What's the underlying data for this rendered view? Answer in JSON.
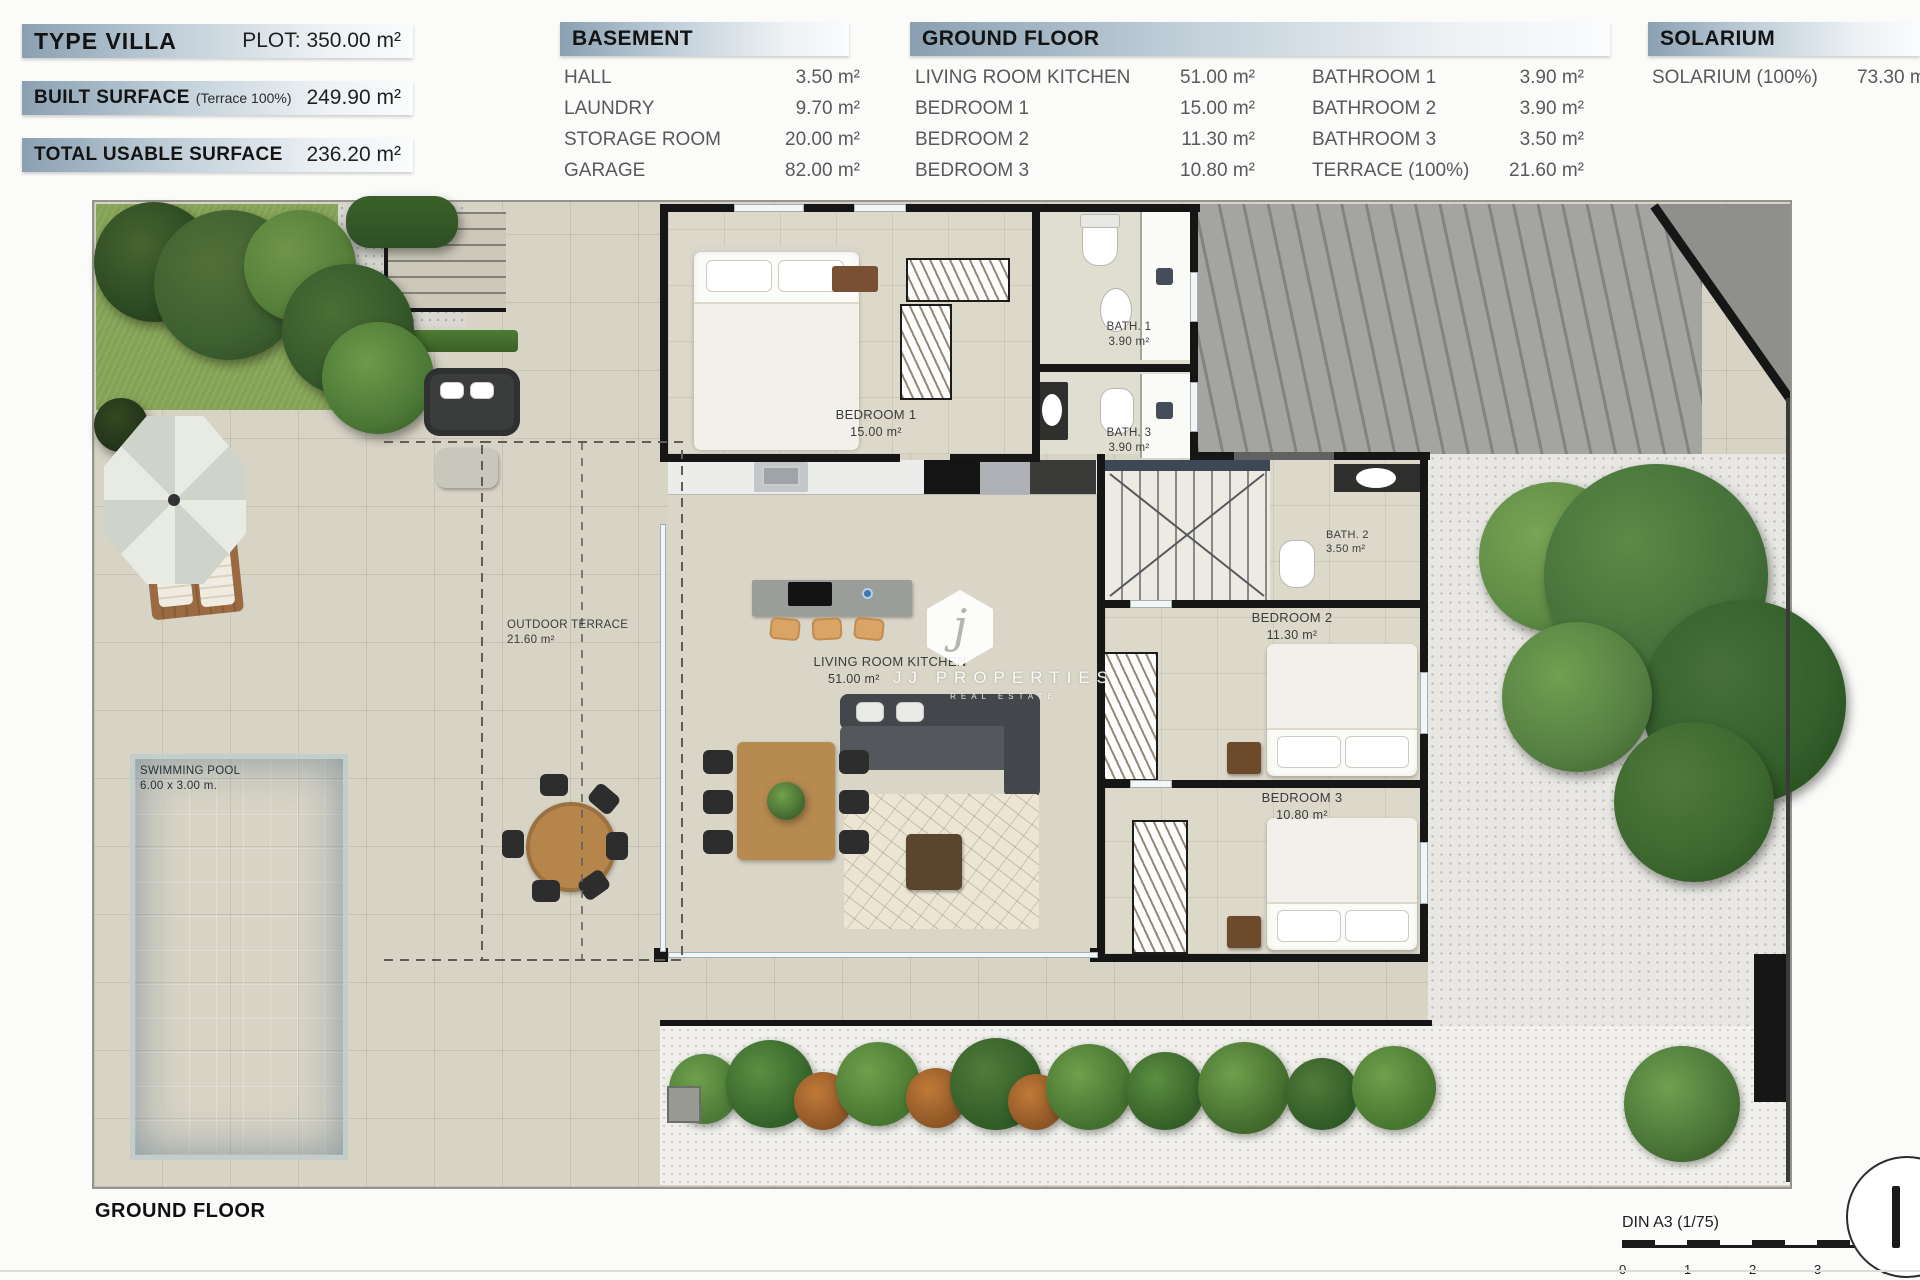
{
  "header": {
    "summary": [
      {
        "label": "TYPE VILLA",
        "sublabel": "",
        "value": "PLOT: 350.00 m²"
      },
      {
        "label": "BUILT SURFACE",
        "sublabel": "(Terrace 100%)",
        "value": "249.90 m²"
      },
      {
        "label": "TOTAL USABLE SURFACE",
        "sublabel": "",
        "value": "236.20 m²"
      }
    ],
    "basement": {
      "title": "BASEMENT",
      "rows": [
        {
          "label": "HALL",
          "value": "3.50 m²"
        },
        {
          "label": "LAUNDRY",
          "value": "9.70 m²"
        },
        {
          "label": "STORAGE ROOM",
          "value": "20.00 m²"
        },
        {
          "label": "GARAGE",
          "value": "82.00 m²"
        }
      ]
    },
    "ground_floor": {
      "title": "GROUND FLOOR",
      "col1": [
        {
          "label": "LIVING ROOM KITCHEN",
          "value": "51.00 m²"
        },
        {
          "label": "BEDROOM 1",
          "value": "15.00 m²"
        },
        {
          "label": "BEDROOM 2",
          "value": "11.30 m²"
        },
        {
          "label": "BEDROOM 3",
          "value": "10.80 m²"
        }
      ],
      "col2": [
        {
          "label": "BATHROOM 1",
          "value": "3.90 m²"
        },
        {
          "label": "BATHROOM 2",
          "value": "3.90 m²"
        },
        {
          "label": "BATHROOM 3",
          "value": "3.50 m²"
        },
        {
          "label": "TERRACE (100%)",
          "value": "21.60 m²"
        }
      ]
    },
    "solarium": {
      "title": "SOLARIUM",
      "rows": [
        {
          "label": "SOLARIUM (100%)",
          "value": "73.30 m²"
        }
      ]
    }
  },
  "plan": {
    "labels": {
      "bedroom1": {
        "name": "BEDROOM 1",
        "area": "15.00 m²"
      },
      "bath1": {
        "name": "BATH. 1",
        "area": "3.90 m²"
      },
      "bath3": {
        "name": "BATH. 3",
        "area": "3.90 m²"
      },
      "bath2": {
        "name": "BATH. 2",
        "area": "3.50 m²"
      },
      "bedroom2": {
        "name": "BEDROOM 2",
        "area": "11.30 m²"
      },
      "bedroom3": {
        "name": "BEDROOM 3",
        "area": "10.80 m²"
      },
      "living": {
        "name": "LIVING ROOM KITCHEN",
        "area": "51.00 m²"
      },
      "terrace": {
        "name": "OUTDOOR TERRACE",
        "area": "21.60 m²"
      },
      "pool": {
        "name": "SWIMMING POOL",
        "dimensions": "6.00 x 3.00 m."
      }
    },
    "watermark": {
      "initial": "j",
      "name": "JJ PROPERTIES",
      "tagline": "REAL ESTATE"
    }
  },
  "footer": {
    "floor_label": "GROUND FLOOR",
    "scale_label": "DIN A3 (1/75)",
    "scale_ticks": [
      "0",
      "1",
      "2",
      "3",
      "4"
    ]
  },
  "colors": {
    "header_bar_start": "#8AA0B2",
    "header_bar_end": "#fafcfd",
    "wall_black": "#161616",
    "pavement": "#d7d3c5",
    "pool_blue": "#5f9ec6",
    "grass_green": "#85a355",
    "gravel_gray": "#a4a4a1"
  }
}
